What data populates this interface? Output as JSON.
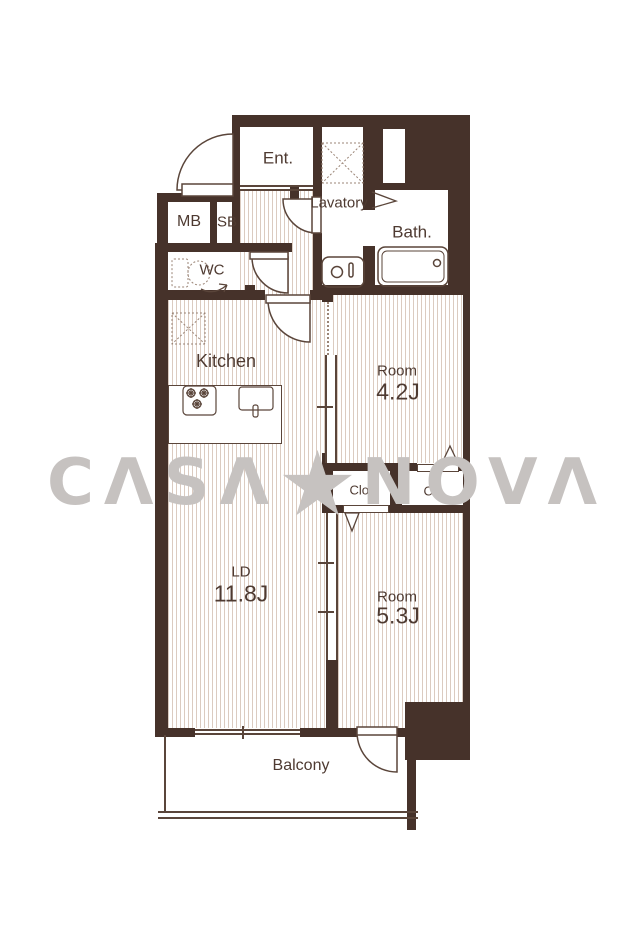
{
  "brand": {
    "watermark_left": "CΛSΛ",
    "watermark_star": "★",
    "watermark_right": "NOVΛ"
  },
  "rooms": {
    "entrance": {
      "label": "Ent."
    },
    "lavatory": {
      "label": "Lavatory"
    },
    "bath": {
      "label": "Bath."
    },
    "meter_box": {
      "label": "MB"
    },
    "shaft_box": {
      "label": "SB"
    },
    "wc": {
      "label": "WC"
    },
    "kitchen": {
      "label": "Kitchen"
    },
    "room_1": {
      "label": "Room",
      "size": "4.2J"
    },
    "closet_left": {
      "label": "Clo."
    },
    "closet_right": {
      "label": "Clo."
    },
    "living_dining": {
      "label": "LD",
      "size": "11.8J"
    },
    "room_2": {
      "label": "Room",
      "size": "5.3J"
    },
    "balcony": {
      "label": "Balcony"
    }
  },
  "colors": {
    "wall": "#46322a",
    "fixture_line": "#5a453a",
    "floor_hatch": "#dbcbc0",
    "text": "#4e3a31",
    "watermark": "#c6c2c0"
  }
}
